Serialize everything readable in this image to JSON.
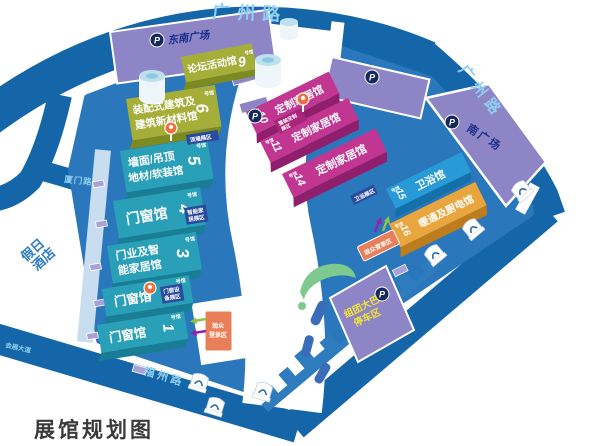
{
  "title": "展馆规划图",
  "roads": {
    "top": "广州路",
    "right": "广州路",
    "bottom": "福州路",
    "west_branch": "厦门路",
    "southwest_avenue": "会展大道"
  },
  "places": {
    "hotel_lines": [
      "假日",
      "酒店"
    ],
    "southeast_plaza": "东南广场",
    "south_plaza": "南广场",
    "bus_parking_lines": [
      "组团大巴",
      "停车区"
    ],
    "parking_letter": "P"
  },
  "halls": [
    {
      "id": "hall-1",
      "number": "1",
      "unit": "号馆",
      "lines": [
        "门窗馆"
      ]
    },
    {
      "id": "hall-2",
      "number": "2",
      "unit": "号馆",
      "lines": [
        "门窗馆"
      ]
    },
    {
      "id": "hall-3",
      "number": "3",
      "unit": "号馆",
      "lines": [
        "门业及智",
        "能家居馆"
      ]
    },
    {
      "id": "hall-4",
      "number": "4",
      "unit": "号馆",
      "lines": [
        "门窗馆"
      ]
    },
    {
      "id": "hall-5",
      "number": "5",
      "unit": "号馆",
      "lines": [
        "墙面/吊顶",
        "地材/软装馆"
      ]
    },
    {
      "id": "hall-6",
      "number": "6",
      "unit": "号馆",
      "lines": [
        "装配式建筑及",
        "建筑新材料馆"
      ]
    },
    {
      "id": "hall-9",
      "number": "9",
      "unit": "号馆",
      "lines": [
        "论坛活动馆"
      ]
    },
    {
      "id": "hall-10",
      "number": "10",
      "unit": "号馆",
      "lines": [
        "定制家居馆"
      ]
    },
    {
      "id": "hall-11",
      "number": "11",
      "unit": "号馆",
      "lines": [
        "定制家居馆"
      ]
    },
    {
      "id": "hall-14",
      "number": "14",
      "unit": "号馆",
      "lines": [
        "定制家居馆"
      ]
    },
    {
      "id": "hall-15",
      "number": "15",
      "unit": "号馆",
      "lines": [
        "卫浴馆"
      ]
    },
    {
      "id": "hall-16",
      "number": "16",
      "unit": "号馆",
      "lines": [
        "暖通及厨电馆"
      ]
    }
  ],
  "zones": {
    "ceiling_wall": "顶墙展区",
    "smart_home_lines": [
      "智能家",
      "居展区"
    ],
    "door_equipment_lines": [
      "门窗设",
      "备展区"
    ],
    "bath_zone": "卫浴展区",
    "custom_full_lines": [
      "整装定制",
      "展区"
    ],
    "visitor_login_lines": [
      "观众",
      "登录区"
    ],
    "visitor_login": "观众登录区"
  },
  "colors": {
    "road": "#1566a9",
    "road_label": "#8fd0f2",
    "platform": "#2b77bb",
    "plaza_purple": "#8d85c6",
    "hall_teal": "#2aa0b8",
    "hall_teal_dark": "#187d95",
    "hall_olive": "#a4ae39",
    "hall_olive_dark": "#7d8a1f",
    "hall_pink": "#c13691",
    "hall_pink_dark": "#8f1f6d",
    "hall_blue": "#289ad8",
    "hall_blue_dark": "#1470a8",
    "hall_orange": "#e9a53e",
    "hall_orange_dark": "#bd7d1c",
    "tag_navy": "#2a4a9b",
    "pin_orange": "#ee6f3c",
    "login_orange": "#e87f58",
    "parking_badge": "#16295e",
    "bus_text_yellow": "#f2e535",
    "green": "#7dc98f",
    "water": "#3a6db8",
    "title_gray": "#3a3a3a",
    "hotel_blue": "#2f7bc4",
    "navy_text": "#1b2f8a"
  }
}
